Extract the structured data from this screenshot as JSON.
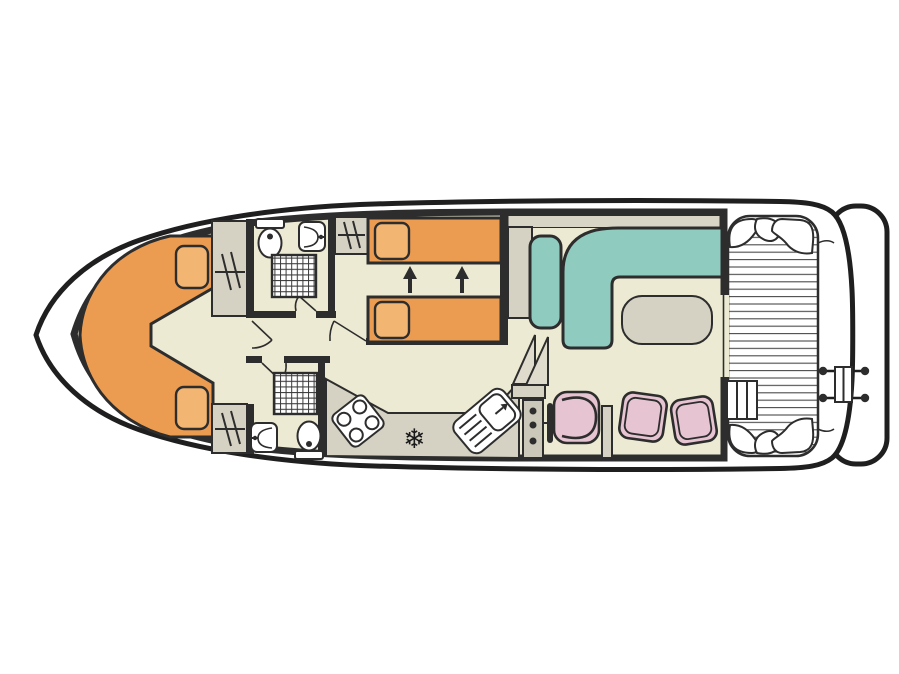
{
  "figure": {
    "type": "boat-deck-floor-plan",
    "icons": {
      "fridge_snowflake": "❄"
    },
    "palette": {
      "outline": "#1f1f1f",
      "wall": "#2d2d2d",
      "floor": "#EDEAD3",
      "furniture": "#D5D2C3",
      "bed": "#EC9C50",
      "pillow": "#F2B572",
      "sofa": "#8FCBBE",
      "chair": "#E6C4D2",
      "deck_line": "#4a4a4a",
      "grid_line": "#3a3a3a",
      "white": "#ffffff"
    }
  }
}
